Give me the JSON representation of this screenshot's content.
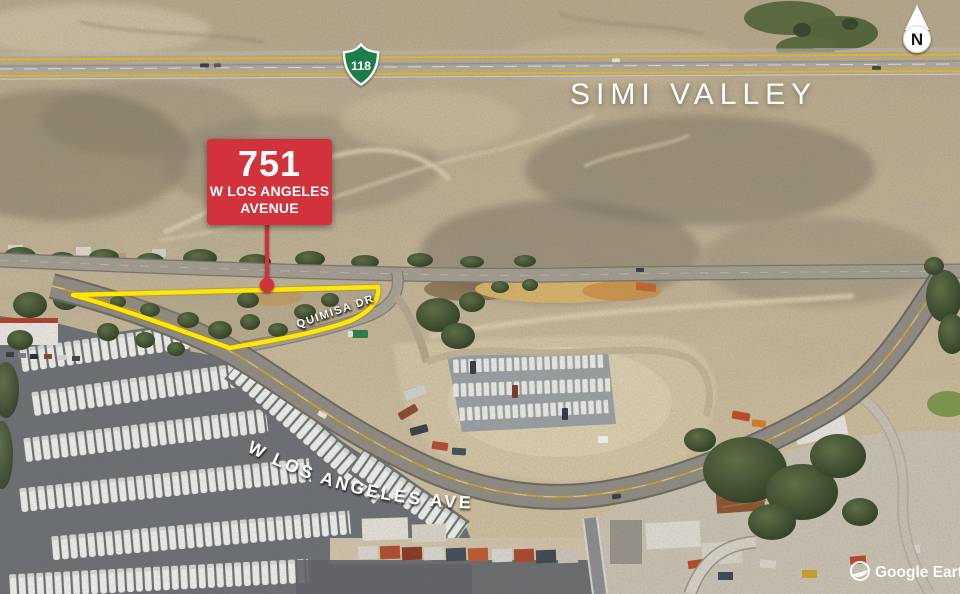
{
  "scene": {
    "city_label": "SIMI VALLEY",
    "highway_shield_number": "118",
    "north_indicator": "N",
    "watermark_text": "Google Earth"
  },
  "callout": {
    "address_number": "751",
    "address_line1": "W LOS ANGELES",
    "address_line2": "AVENUE"
  },
  "road_labels": {
    "quimisa_dr": "QUIMISA DR",
    "w_los_angeles_ave": "W LOS ANGELES AVE"
  },
  "colors": {
    "callout_red": "#d2323b",
    "parcel_outline_yellow": "#ffe604",
    "shield_green": "#1a7b4b",
    "freeway_stripe_yellow": "#e7bc25"
  }
}
